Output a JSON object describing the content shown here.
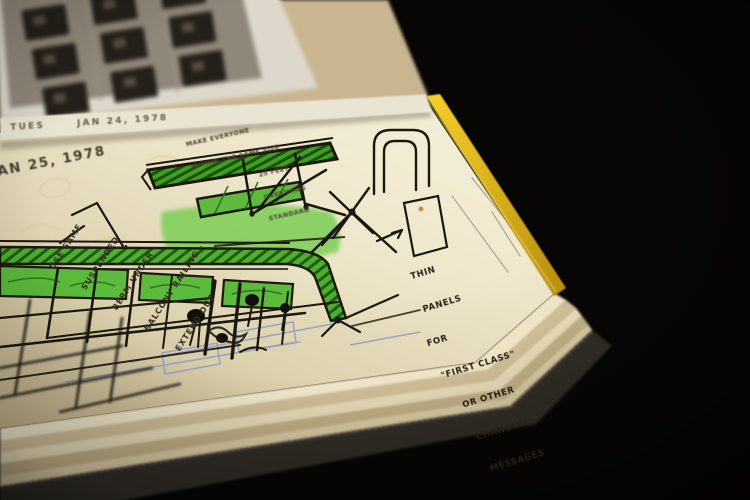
{
  "photo": {
    "background_color": "#070605",
    "notebook": {
      "page_color": "#e9e0c4",
      "cover_color": "#302d26",
      "page_edge_yellow": "#e8bf1c",
      "marker_green": "#53b437",
      "marker_green_dark": "#1d5c10",
      "ink_color": "#1c1710",
      "pencil_blue": "#8d9cc4"
    },
    "prev_page": {
      "date_label": "TUES      JAN 24, 1978",
      "contact_sheet": {
        "rows": 3,
        "cols": 3
      }
    },
    "sketch_page": {
      "date_label": "AN 25, 1978",
      "left_note": {
        "lines": [
          "USE SAME",
          "SUSPENDED",
          "BERM UNDER",
          "BALCONY RAILING -",
          "EXTEND OUT"
        ]
      },
      "top_note": {
        "lines": [
          "MAKE EVERYONE",
          "WITHIN THE SAME SIZE",
          "25 FEET",
          "OVERHANG",
          "STANDARD"
        ]
      },
      "right_note": {
        "lines": [
          "THIN",
          "PANELS",
          "FOR",
          "\"FIRST CLASS\"",
          "OR OTHER",
          "CHANGING",
          "MESSAGES"
        ]
      }
    }
  }
}
